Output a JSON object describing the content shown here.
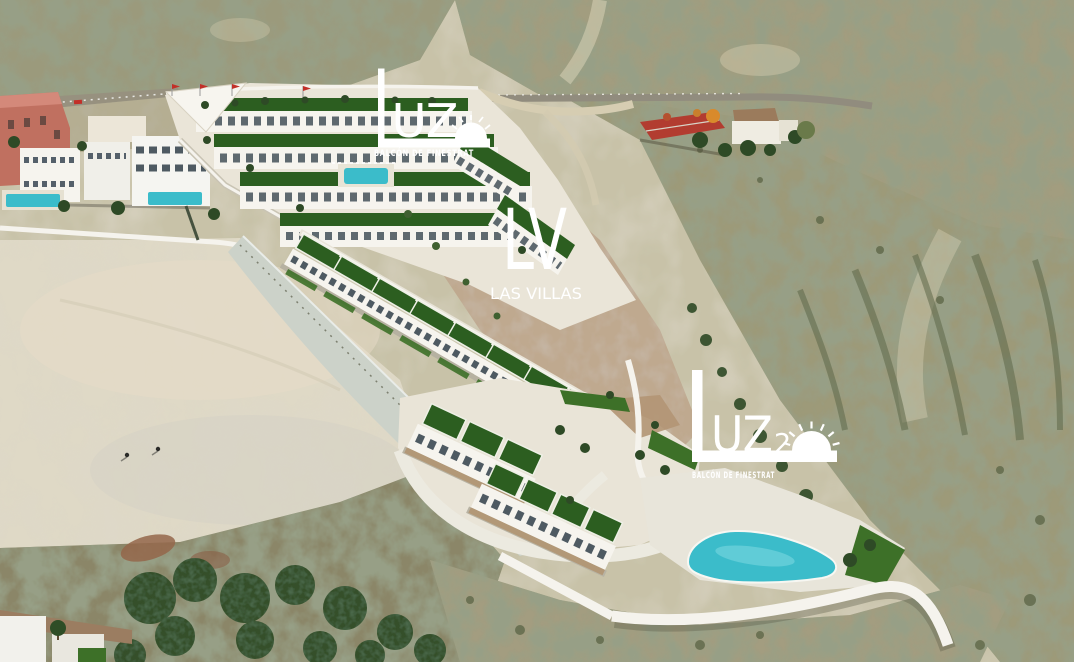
{
  "image": {
    "kind": "aerial-photograph-with-architectural-render",
    "alt": "Aerial view of a scrub-covered hillside with a terraced white villa development render, empty sand plot, farm houses and communal pool"
  },
  "overlays": {
    "logo_top": {
      "word": "LUZ",
      "word_tail": "UZ",
      "tagline": "BALCÓN DE FINESTRAT",
      "icon": "setting-sun-icon"
    },
    "monogram": {
      "initials": "LV",
      "name": "LAS VILLAS"
    },
    "logo_bottom": {
      "word": "LUZ",
      "word_tail": "UZ",
      "number": "2",
      "tagline": "BALCÓN DE FINESTRAT",
      "icon": "rising-sun-icon"
    }
  },
  "palette": {
    "overlay_white": "#ffffff",
    "render_white": "#f6f4ee",
    "roof_green": "#2c5e20",
    "lawn_green": "#3d7028",
    "pool_turquoise": "#3bbcca",
    "flag_red": "#c22f28",
    "terrain_base": "#c8c2a8",
    "scrub_olive": "#9d9a79",
    "dirt_plot": "#dfd9c6",
    "graded_slope": "#ccd2c9",
    "wall_white": "#f5f3ed",
    "salmon_building": "#c07060",
    "shed_roof_red": "#b23c30",
    "farm_roof_brown": "#9b7b5c",
    "plaza_brown": "#ad8a64",
    "tree_dark_green": "#2e4a26"
  }
}
